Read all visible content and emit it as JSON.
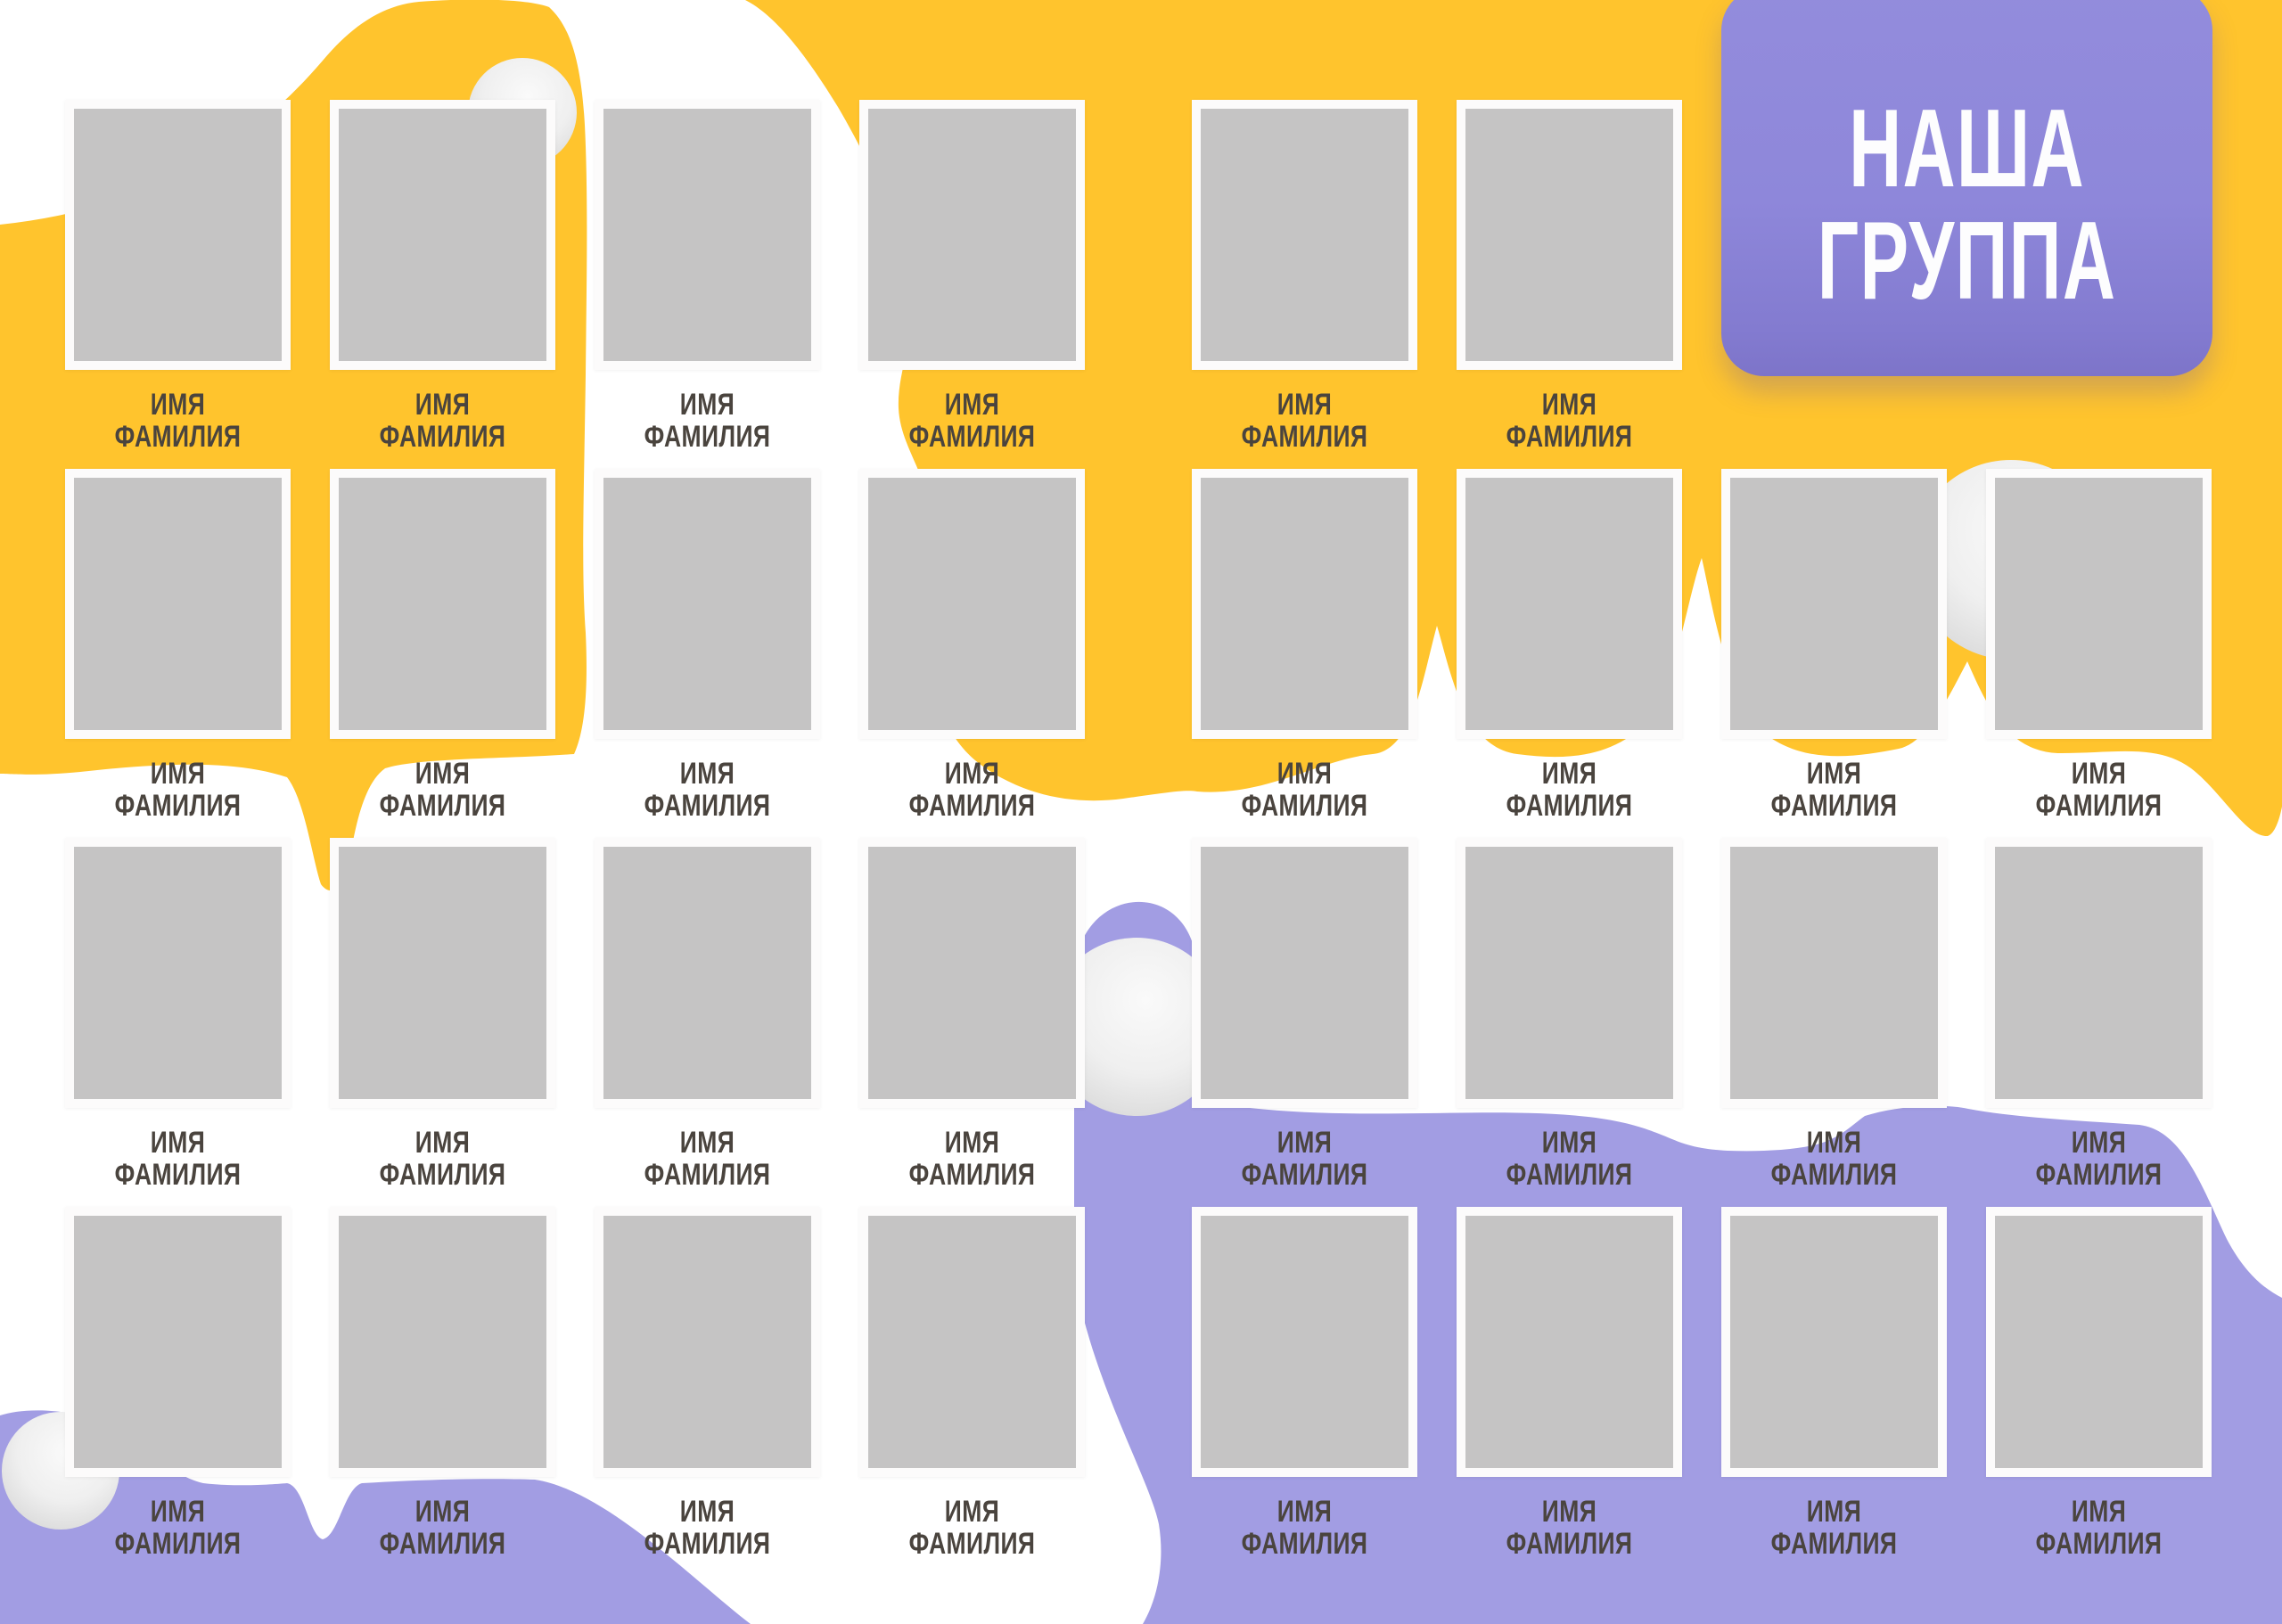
{
  "title": {
    "line1": "НАША",
    "line2": "ГРУППА"
  },
  "tile_label": {
    "line1": "ИМЯ",
    "line2": "ФАМИЛИЯ"
  },
  "grid": {
    "rows": [
      {
        "tile_count": 6
      },
      {
        "tile_count": 8
      },
      {
        "tile_count": 8
      },
      {
        "tile_count": 8
      }
    ]
  },
  "colors": {
    "background": "#ffffff",
    "yellow_blob": "#ffc42d",
    "card_purple": "#8e87da",
    "blob_purple": "#a29de3",
    "photo_gray": "#c5c4c4",
    "frame_white": "#fcfbfb",
    "label_text": "#4a443e",
    "title_text": "#fdfdfe"
  }
}
